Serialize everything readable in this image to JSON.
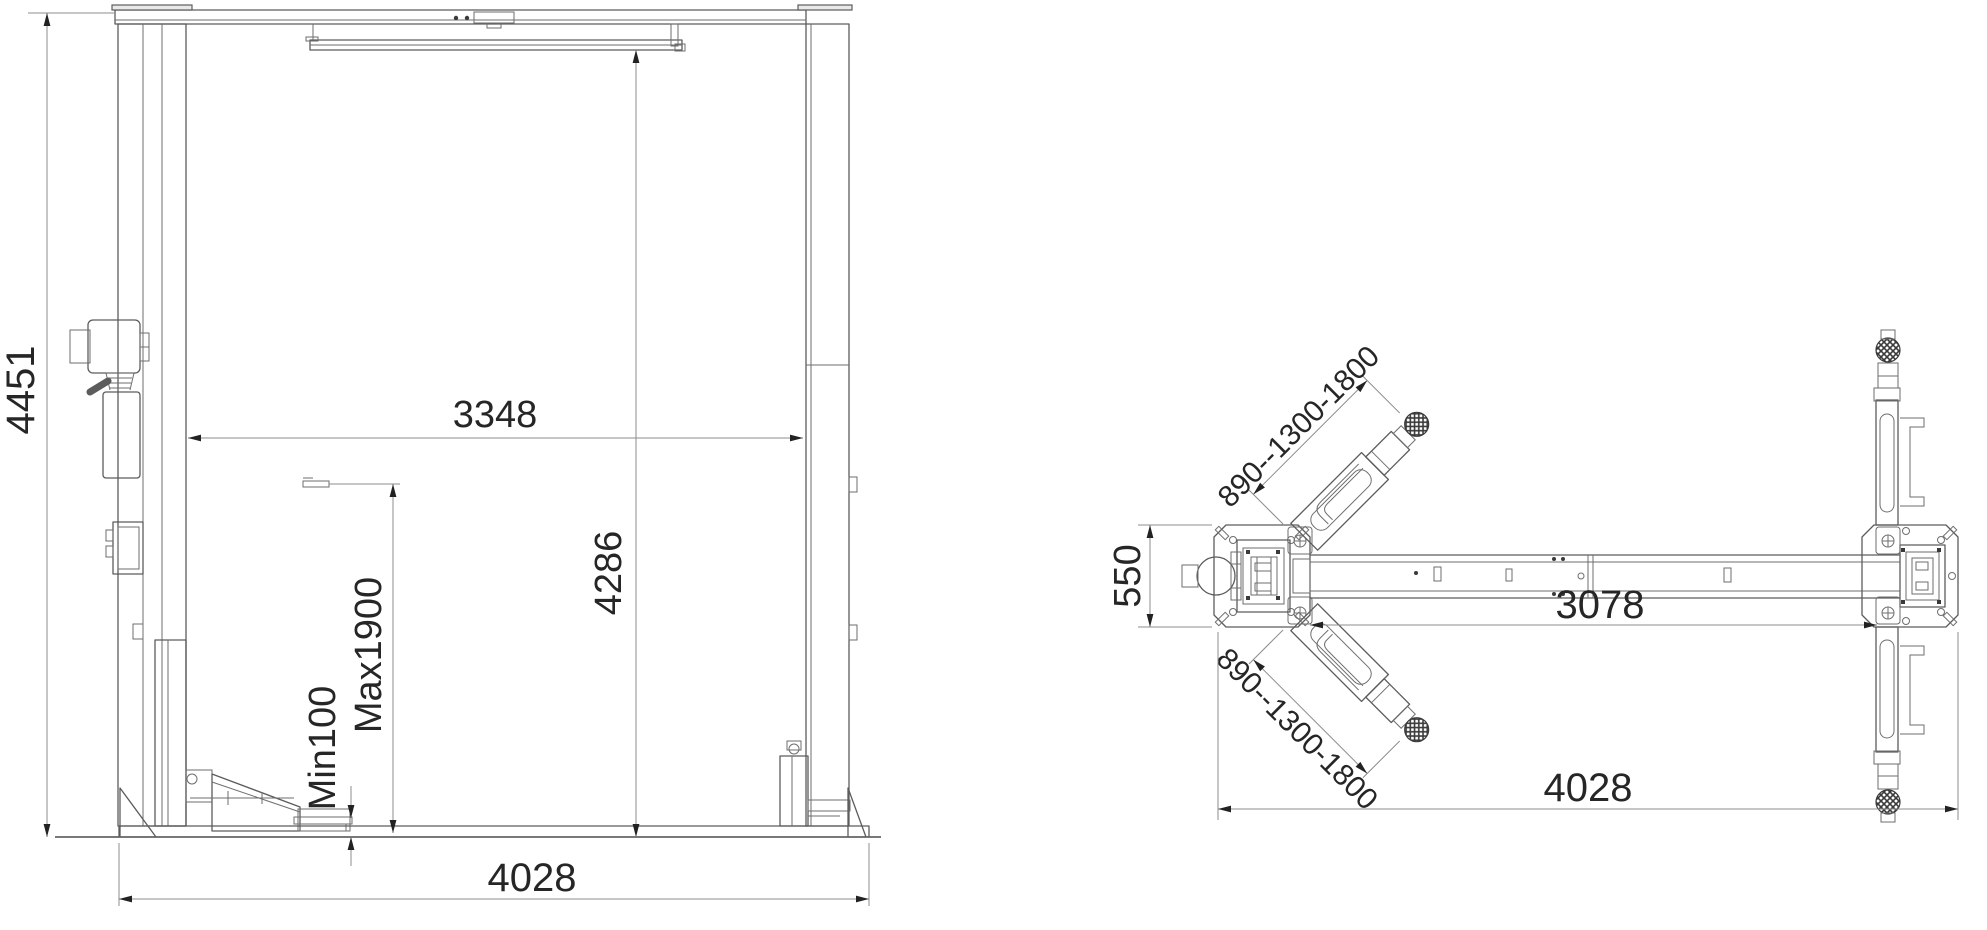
{
  "front_view": {
    "overall_height": "4451",
    "inner_width": "3348",
    "clearance_height": "4286",
    "max_lift_height": "Max1900",
    "min_pad_height": "Min100",
    "overall_width": "4028"
  },
  "top_view": {
    "upper_arm_reach": "890--1300-1800",
    "lower_arm_reach": "890--1300-1800",
    "base_plate_depth": "550",
    "inner_span": "3078",
    "overall_width": "4028"
  },
  "colors": {
    "background": "#ffffff",
    "geometry_line": "#5c5c5c",
    "dimension_line": "#8c8c8c",
    "dimension_text": "#262626",
    "arrow": "#222222"
  }
}
